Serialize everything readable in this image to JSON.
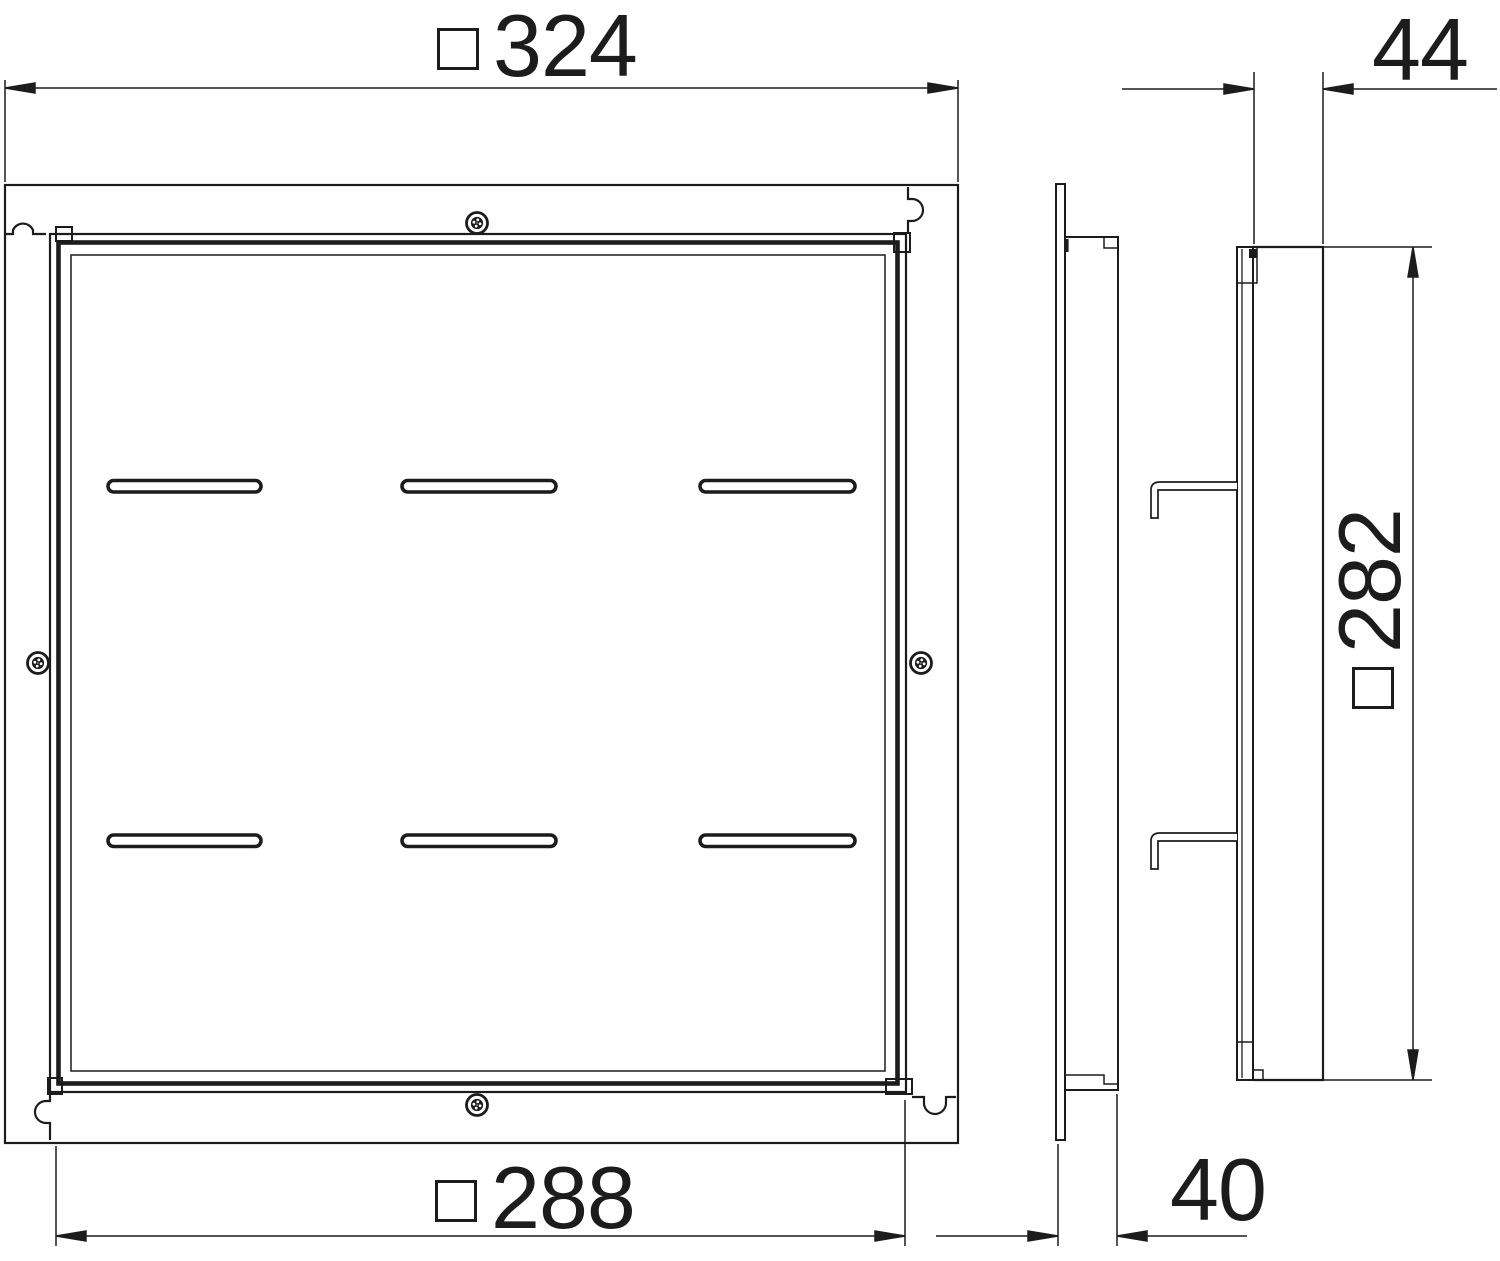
{
  "document": {
    "type": "technical-drawing",
    "background_color": "#ffffff",
    "line_color": "#1c1c1c"
  },
  "views": {
    "front": {
      "screw_count": 4,
      "slot_rows": 2,
      "slots_per_row": 3,
      "corner_keyhole_count": 4
    },
    "left_side": {
      "mounting_claw_count": 1
    },
    "right_side": {
      "mounting_claw_count": 2
    }
  },
  "dimensions": {
    "outer_width": {
      "value": "324",
      "square_symbol": true
    },
    "inner_width": {
      "value": "288",
      "square_symbol": true
    },
    "side_height": {
      "value": "282",
      "square_symbol": true
    },
    "right_view_depth": {
      "value": "44",
      "square_symbol": false
    },
    "left_view_depth": {
      "value": "40",
      "square_symbol": false
    }
  }
}
